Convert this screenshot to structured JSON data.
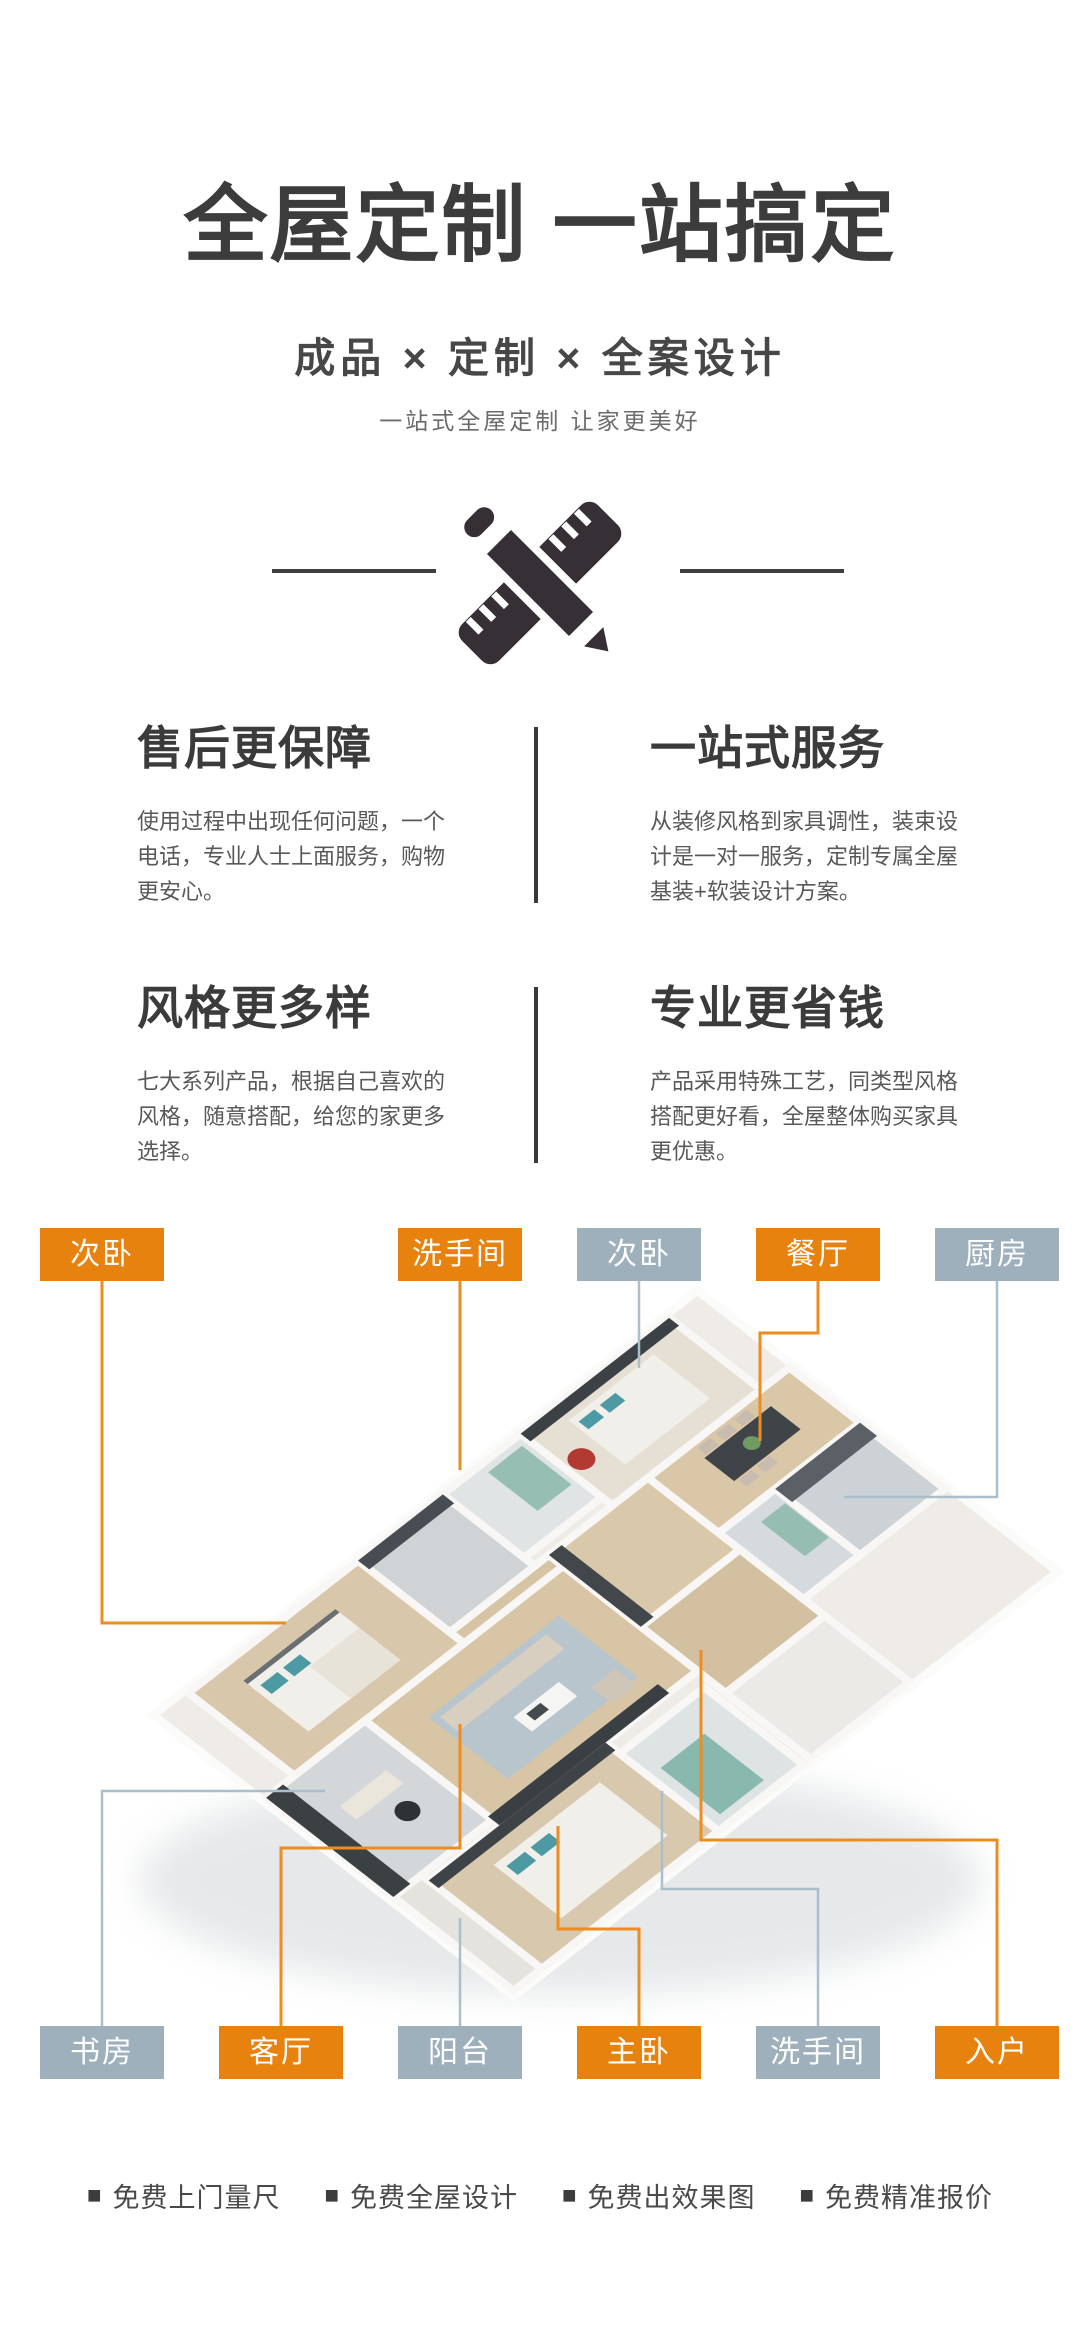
{
  "hero": {
    "title": "全屋定制 一站搞定",
    "subtitle": "成品 × 定制 × 全案设计",
    "tagline": "一站式全屋定制 让家更美好",
    "icon": "pencil-ruler-icon"
  },
  "features": [
    {
      "title": "售后更保障",
      "desc": "使用过程中出现任何问题，一个电话，专业人士上面服务，购物更安心。"
    },
    {
      "title": "一站式服务",
      "desc": "从装修风格到家具调性，装束设计是一对一服务，定制专属全屋基装+软装设计方案。"
    },
    {
      "title": "风格更多样",
      "desc": "七大系列产品，根据自己喜欢的风格，随意搭配，给您的家更多选择。"
    },
    {
      "title": "专业更省钱",
      "desc": "产品采用特殊工艺，同类型风格搭配更好看，全屋整体购买家具更优惠。"
    }
  ],
  "floorplan": {
    "top_labels": [
      {
        "text": "次卧",
        "color": "orange"
      },
      {
        "text": "洗手间",
        "color": "orange"
      },
      {
        "text": "次卧",
        "color": "gray"
      },
      {
        "text": "餐厅",
        "color": "orange"
      },
      {
        "text": "厨房",
        "color": "gray"
      }
    ],
    "bottom_labels": [
      {
        "text": "书房",
        "color": "gray"
      },
      {
        "text": "客厅",
        "color": "orange"
      },
      {
        "text": "阳台",
        "color": "gray"
      },
      {
        "text": "主卧",
        "color": "orange"
      },
      {
        "text": "洗手间",
        "color": "gray"
      },
      {
        "text": "入户",
        "color": "orange"
      }
    ],
    "colors": {
      "label_orange": "#e8820f",
      "label_gray": "#9fb0bd",
      "line_orange": "#ed8d21",
      "line_gray": "#aabfcb",
      "label_text": "#ffffff"
    }
  },
  "footer": {
    "bullet": "■",
    "items": [
      "免费上门量尺",
      "免费全屋设计",
      "免费出效果图",
      "免费精准报价"
    ]
  }
}
